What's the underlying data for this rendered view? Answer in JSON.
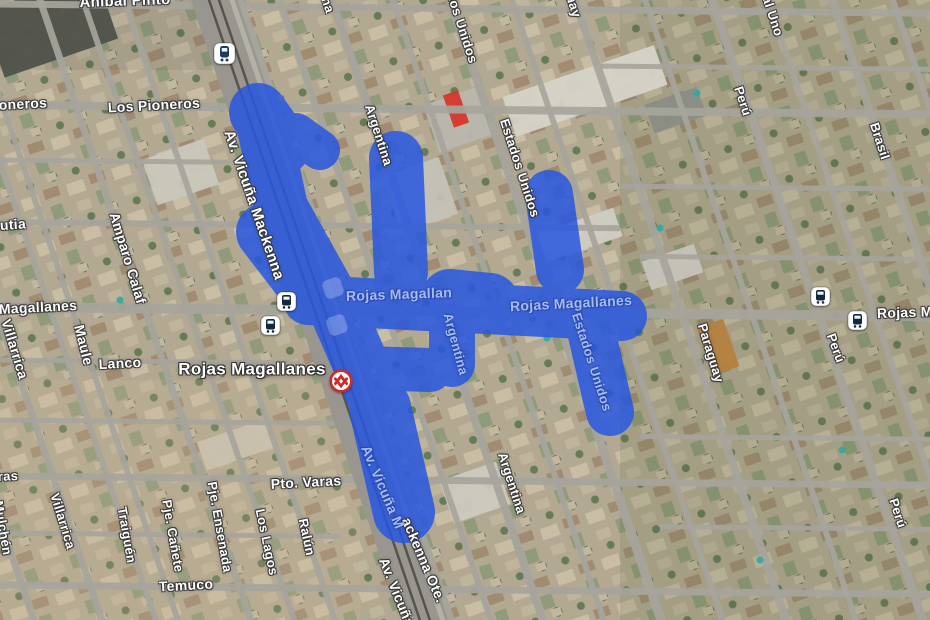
{
  "map": {
    "overlay": {
      "color": "#2857e0",
      "opacity": 0.85,
      "segments": [
        [
          258,
          112,
          282,
          146,
          58
        ],
        [
          296,
          133,
          320,
          150,
          40
        ],
        [
          262,
          118,
          281,
          208,
          54
        ],
        [
          281,
          208,
          335,
          305,
          54
        ],
        [
          265,
          232,
          308,
          288,
          58
        ],
        [
          335,
          305,
          380,
          408,
          56
        ],
        [
          380,
          408,
          404,
          512,
          62
        ],
        [
          396,
          158,
          401,
          272,
          54
        ],
        [
          549,
          194,
          560,
          270,
          48
        ],
        [
          308,
          300,
          622,
          316,
          50
        ],
        [
          450,
          298,
          490,
          302,
          58
        ],
        [
          452,
          324,
          452,
          364,
          46
        ],
        [
          364,
          368,
          430,
          370,
          44
        ],
        [
          590,
          326,
          610,
          412,
          48
        ]
      ]
    },
    "terrain": {
      "base_color": "#b3a992",
      "street_color": "#a7a59c",
      "avenue_color": "#98968e",
      "rail_color": "#55534b",
      "tile_colors": [
        "#c9bda3",
        "#a18c72",
        "#bfb49c",
        "#8f9b7a",
        "#5c7052",
        "#667b58",
        "#c3b89f"
      ],
      "tints": [
        [
          620,
          0,
          310,
          620,
          "rgba(75,95,60,0.14)"
        ],
        [
          0,
          380,
          360,
          240,
          "rgba(205,185,150,0.18)"
        ],
        [
          0,
          0,
          220,
          70,
          "rgba(60,70,55,0.10)"
        ]
      ],
      "slope_vertical": 0.34,
      "slope_horizontal": 0.01,
      "vertical_streets": [
        [
          -177,
          7
        ],
        [
          -109,
          7
        ],
        [
          -55,
          6
        ],
        [
          -33,
          6
        ],
        [
          40,
          7
        ],
        [
          83,
          6
        ],
        [
          124,
          6
        ],
        [
          240,
          8
        ],
        [
          280,
          6
        ],
        [
          332,
          8
        ],
        [
          393,
          6
        ],
        [
          450,
          9
        ],
        [
          512,
          6
        ],
        [
          575,
          8
        ],
        [
          645,
          6
        ],
        [
          712,
          8
        ],
        [
          768,
          6
        ],
        [
          832,
          8
        ],
        [
          893,
          6
        ]
      ],
      "horizontal_streets": [
        [
          4,
          7,
          -10,
          940
        ],
        [
          105,
          8,
          -10,
          940
        ],
        [
          160,
          5,
          -10,
          230
        ],
        [
          222,
          6,
          -10,
          620
        ],
        [
          307,
          10,
          -10,
          940
        ],
        [
          360,
          5,
          -10,
          300
        ],
        [
          420,
          5,
          -10,
          340
        ],
        [
          476,
          7,
          -10,
          940
        ],
        [
          533,
          5,
          -10,
          340
        ],
        [
          585,
          7,
          -10,
          940
        ],
        [
          60,
          5,
          600,
          940
        ],
        [
          180,
          5,
          620,
          940
        ],
        [
          250,
          5,
          640,
          940
        ],
        [
          430,
          5,
          640,
          940
        ],
        [
          520,
          5,
          660,
          940
        ]
      ],
      "avenue": {
        "x0": 214,
        "width": 44,
        "rail_offsets": [
          -5,
          5
        ],
        "edge_offset": 18
      },
      "buildings": [
        [
          -10,
          -10,
          120,
          70,
          "#4f524b"
        ],
        [
          505,
          70,
          160,
          42,
          "#d6d3c8"
        ],
        [
          430,
          95,
          55,
          50,
          "#b9b7ae"
        ],
        [
          390,
          165,
          60,
          60,
          "#c4c1b8"
        ],
        [
          148,
          148,
          65,
          48,
          "#cac7bd"
        ],
        [
          540,
          220,
          80,
          30,
          "#d0cdc3"
        ],
        [
          645,
          252,
          55,
          30,
          "#c6c3b9"
        ],
        [
          445,
          470,
          60,
          45,
          "#ccc9bf"
        ],
        [
          200,
          430,
          70,
          30,
          "#c9c1ae"
        ],
        [
          704,
          322,
          28,
          50,
          "#b5813f"
        ],
        [
          648,
          95,
          55,
          30,
          "#8a8d84"
        ],
        [
          448,
          92,
          16,
          34,
          "#d6362c"
        ]
      ],
      "pools": [
        [
          547,
          338
        ],
        [
          697,
          93
        ],
        [
          660,
          228
        ],
        [
          842,
          450
        ],
        [
          120,
          300
        ],
        [
          760,
          560
        ]
      ]
    },
    "labels": [
      {
        "t": "Aníbal Pinto",
        "x": 125,
        "y": 1,
        "r": -2,
        "s": 15,
        "k": "white"
      },
      {
        "t": "Los Pioneros",
        "x": 154,
        "y": 105,
        "r": -3,
        "s": 14,
        "k": "white"
      },
      {
        "t": "Pioneros",
        "x": 16,
        "y": 104,
        "r": -3,
        "s": 14,
        "k": "white"
      },
      {
        "t": "Urrutia",
        "x": 2,
        "y": 225,
        "r": -4,
        "s": 14,
        "k": "white"
      },
      {
        "t": "Amparo Calaf",
        "x": 128,
        "y": 258,
        "r": 73,
        "s": 14,
        "k": "white"
      },
      {
        "t": "Magallanes",
        "x": 38,
        "y": 307,
        "r": -3,
        "s": 14,
        "k": "white"
      },
      {
        "t": "Villarrica",
        "x": 15,
        "y": 349,
        "r": 73,
        "s": 14,
        "k": "white"
      },
      {
        "t": "Maule",
        "x": 84,
        "y": 345,
        "r": 76,
        "s": 14,
        "k": "white"
      },
      {
        "t": "Lanco",
        "x": 120,
        "y": 363,
        "r": -3,
        "s": 14,
        "k": "white"
      },
      {
        "t": "Av. Vicuña Mackenna",
        "x": 254,
        "y": 205,
        "r": 71,
        "s": 15,
        "k": "white"
      },
      {
        "t": "Pto. Varas",
        "x": 306,
        "y": 482,
        "r": -3,
        "s": 14,
        "k": "white"
      },
      {
        "t": "Villarrica",
        "x": 63,
        "y": 521,
        "r": 73,
        "s": 13,
        "k": "white"
      },
      {
        "t": "Mulchén",
        "x": 3,
        "y": 528,
        "r": 80,
        "s": 13,
        "k": "white"
      },
      {
        "t": "Traiguén",
        "x": 127,
        "y": 535,
        "r": 80,
        "s": 13,
        "k": "white"
      },
      {
        "t": "Pje. Cañete",
        "x": 173,
        "y": 536,
        "r": 80,
        "s": 13,
        "k": "white"
      },
      {
        "t": "Pje. Ensenada",
        "x": 220,
        "y": 527,
        "r": 80,
        "s": 13,
        "k": "white"
      },
      {
        "t": "Los Lagos",
        "x": 267,
        "y": 542,
        "r": 78,
        "s": 13,
        "k": "white"
      },
      {
        "t": "Ralún",
        "x": 307,
        "y": 537,
        "r": 78,
        "s": 13,
        "k": "white"
      },
      {
        "t": "Temuco",
        "x": 186,
        "y": 585,
        "r": -3,
        "s": 14,
        "k": "white"
      },
      {
        "t": "ras",
        "x": 8,
        "y": 476,
        "r": -3,
        "s": 13,
        "k": "white"
      },
      {
        "t": "Argentina",
        "x": 379,
        "y": 135,
        "r": 72,
        "s": 13,
        "k": "white"
      },
      {
        "t": "na",
        "x": 328,
        "y": 5,
        "r": 72,
        "s": 13,
        "k": "white"
      },
      {
        "t": "Estados Unidos",
        "x": 458,
        "y": 14,
        "r": 72,
        "s": 13,
        "k": "white"
      },
      {
        "t": "Estados Unidos",
        "x": 520,
        "y": 168,
        "r": 72,
        "s": 13,
        "k": "white"
      },
      {
        "t": "Paraguay",
        "x": 568,
        "y": -12,
        "r": 72,
        "s": 13,
        "k": "white"
      },
      {
        "t": "al Uno",
        "x": 773,
        "y": 16,
        "r": 72,
        "s": 13,
        "k": "white"
      },
      {
        "t": "Perú",
        "x": 743,
        "y": 101,
        "r": 72,
        "s": 13,
        "k": "white"
      },
      {
        "t": "Brasil",
        "x": 880,
        "y": 141,
        "r": 72,
        "s": 13,
        "k": "white"
      },
      {
        "t": "Paraguay",
        "x": 711,
        "y": 353,
        "r": 73,
        "s": 13,
        "k": "white"
      },
      {
        "t": "Perú",
        "x": 836,
        "y": 348,
        "r": 70,
        "s": 13,
        "k": "white"
      },
      {
        "t": "Rojas Magallanes",
        "x": 938,
        "y": 311,
        "r": -2,
        "s": 14,
        "k": "white"
      },
      {
        "t": "Perú",
        "x": 898,
        "y": 513,
        "r": 72,
        "s": 13,
        "k": "white"
      },
      {
        "t": "Argentina",
        "x": 512,
        "y": 483,
        "r": 72,
        "s": 13,
        "k": "white"
      },
      {
        "t": "ackenna Ote.",
        "x": 424,
        "y": 560,
        "r": 67,
        "s": 14,
        "k": "white"
      },
      {
        "t": "Av. Vicuña",
        "x": 397,
        "y": 592,
        "r": 68,
        "s": 14,
        "k": "white"
      },
      {
        "t": "Rojas Magallan",
        "x": 399,
        "y": 294,
        "r": -2,
        "s": 14,
        "k": "ghost"
      },
      {
        "t": "Rojas Magallanes",
        "x": 571,
        "y": 303,
        "r": -3,
        "s": 14,
        "k": "ghost"
      },
      {
        "t": "Argentina",
        "x": 456,
        "y": 344,
        "r": 75,
        "s": 13,
        "k": "ghost"
      },
      {
        "t": "Estados Unidos",
        "x": 592,
        "y": 362,
        "r": 72,
        "s": 13,
        "k": "ghost"
      },
      {
        "t": "Av. Vicuña M",
        "x": 383,
        "y": 487,
        "r": 67,
        "s": 14,
        "k": "ghost"
      },
      {
        "t": "Rojas Magallanes",
        "x": 252,
        "y": 369,
        "r": 0,
        "s": 17,
        "k": "station"
      }
    ],
    "icons": [
      {
        "type": "train",
        "x": 213,
        "y": 42
      },
      {
        "type": "bus",
        "x": 276,
        "y": 291
      },
      {
        "type": "bus",
        "x": 260,
        "y": 315
      },
      {
        "type": "bus",
        "x": 810,
        "y": 286
      },
      {
        "type": "bus",
        "x": 847,
        "y": 310
      },
      {
        "type": "metro",
        "x": 329,
        "y": 369
      },
      {
        "type": "ghost",
        "x": 333,
        "y": 288
      },
      {
        "type": "ghost",
        "x": 337,
        "y": 325
      }
    ]
  }
}
